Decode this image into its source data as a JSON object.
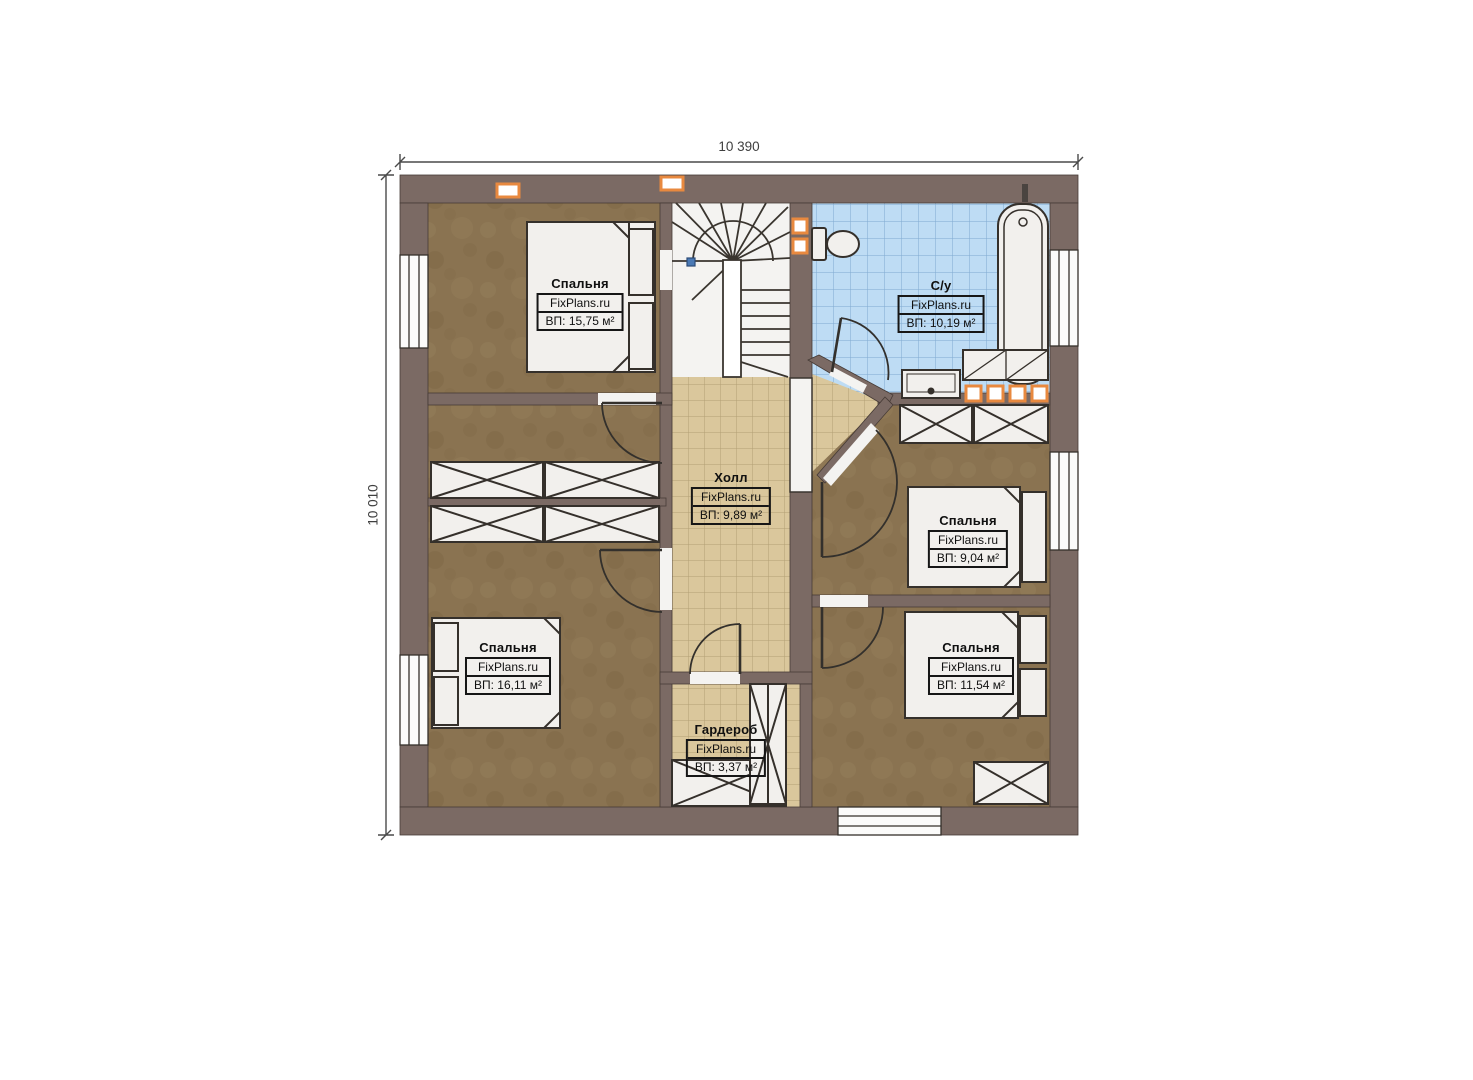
{
  "plan": {
    "dimensions": {
      "width": "10 390",
      "height": "10 010"
    },
    "rooms": [
      {
        "name": "Спальня",
        "brand": "FixPlans.ru",
        "area": "ВП: 15,75 м²"
      },
      {
        "name": "С/у",
        "brand": "FixPlans.ru",
        "area": "ВП: 10,19 м²"
      },
      {
        "name": "Холл",
        "brand": "FixPlans.ru",
        "area": "ВП: 9,89 м²"
      },
      {
        "name": "Спальня",
        "brand": "FixPlans.ru",
        "area": "ВП: 9,04 м²"
      },
      {
        "name": "Спальня",
        "brand": "FixPlans.ru",
        "area": "ВП: 11,54 м²"
      },
      {
        "name": "Спальня",
        "brand": "FixPlans.ru",
        "area": "ВП: 16,11 м²"
      },
      {
        "name": "Гардероб",
        "brand": "FixPlans.ru",
        "area": "ВП: 3,37 м²"
      }
    ],
    "colors": {
      "wall": "#7b6a64",
      "bedroom_floor": "#8a7351",
      "hall_floor": "#dac79c",
      "bathroom_floor": "#bedcf4",
      "accent": "#e8893f",
      "stairs_marker": "#4a79b5"
    }
  }
}
